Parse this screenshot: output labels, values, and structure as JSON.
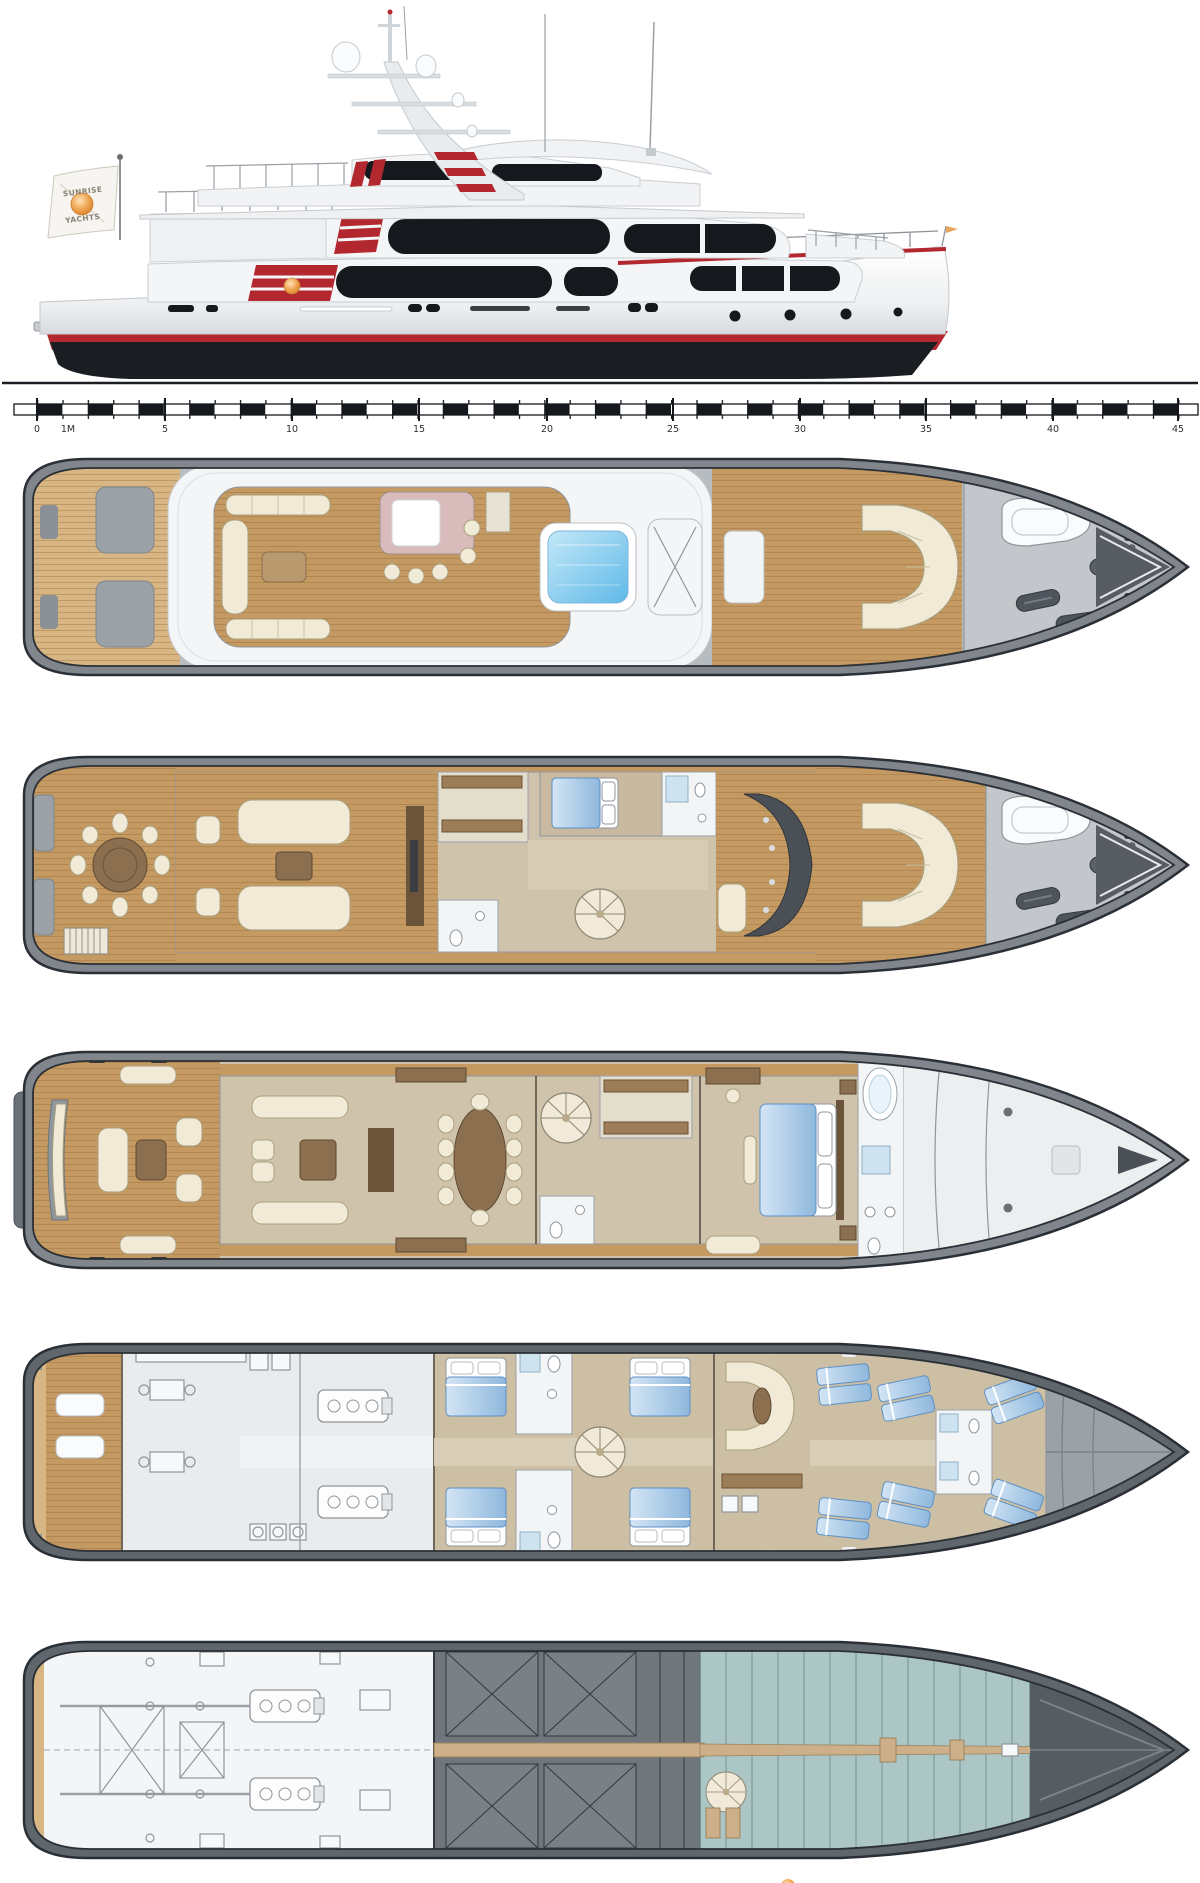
{
  "window": {
    "background": "#ffffff"
  },
  "profile": {
    "flag_line1": "SUNRISE",
    "flag_line2": "YACHTS"
  },
  "ruler": {
    "labels": [
      "0",
      "1M",
      "5",
      "10",
      "15",
      "20",
      "25",
      "30",
      "35",
      "40",
      "45"
    ]
  },
  "colors": {
    "accent_red": "#b3282e",
    "hull_black": "#1a1d21",
    "logo_orange": "#e08a32",
    "teak": "#c59a62",
    "teak_light": "#d8b683",
    "pool_blue": "#6cc1ee",
    "bed_blue": "#a9ccec",
    "bar_pink": "#d8bcbc",
    "cream": "#f0ead6",
    "wood_brown": "#8b6f4f",
    "house_floor": "#cfc3ab",
    "cabin_floor": "#cdbfa4",
    "tech_gray": "#e9ebec",
    "tank_gray": "#70767c",
    "bilge_teal": "#abc6c5",
    "keel_tan": "#cdb089",
    "foredeck_gray": "#c3c7cb",
    "gunwale_gray": "#80868c"
  }
}
